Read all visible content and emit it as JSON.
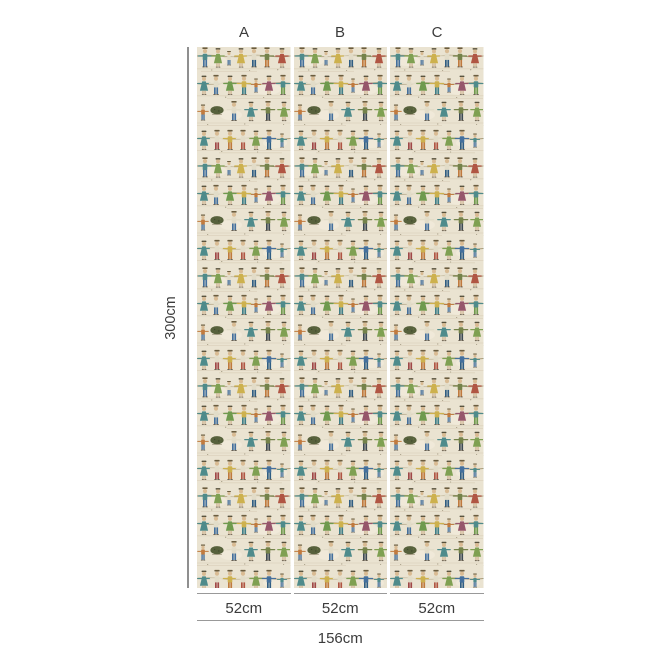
{
  "diagram": {
    "panels": [
      {
        "label": "A",
        "width_label": "52cm"
      },
      {
        "label": "B",
        "width_label": "52cm"
      },
      {
        "label": "C",
        "width_label": "52cm"
      }
    ],
    "height_label": "300cm",
    "total_width_label": "156cm"
  },
  "pattern": {
    "description": "Folk-art wallpaper mural: repeating rows of hand-drawn people holding hands along lines, with dark shrubs, on cream textured ground; identical pattern on all three panels",
    "background_color": "#eae3d1",
    "palette": {
      "blue": "#44709d",
      "navy": "#2f5d83",
      "teal": "#4f8b8b",
      "teal_dark": "#3f7f88",
      "green": "#7fa052",
      "green_dark": "#6f9a4e",
      "olive": "#74824a",
      "bush": "#57613c",
      "yellow": "#cdb14e",
      "orange": "#c07a3e",
      "red": "#b05543",
      "maroon": "#a04848",
      "plum": "#96566b",
      "skin": "#d9bb93",
      "cream_shirt": "#e2dcc8",
      "hold_line": "#a5946f"
    }
  },
  "dimension_style": {
    "line_color": "#8f8f8f",
    "text_color": "#3b3b3b"
  }
}
